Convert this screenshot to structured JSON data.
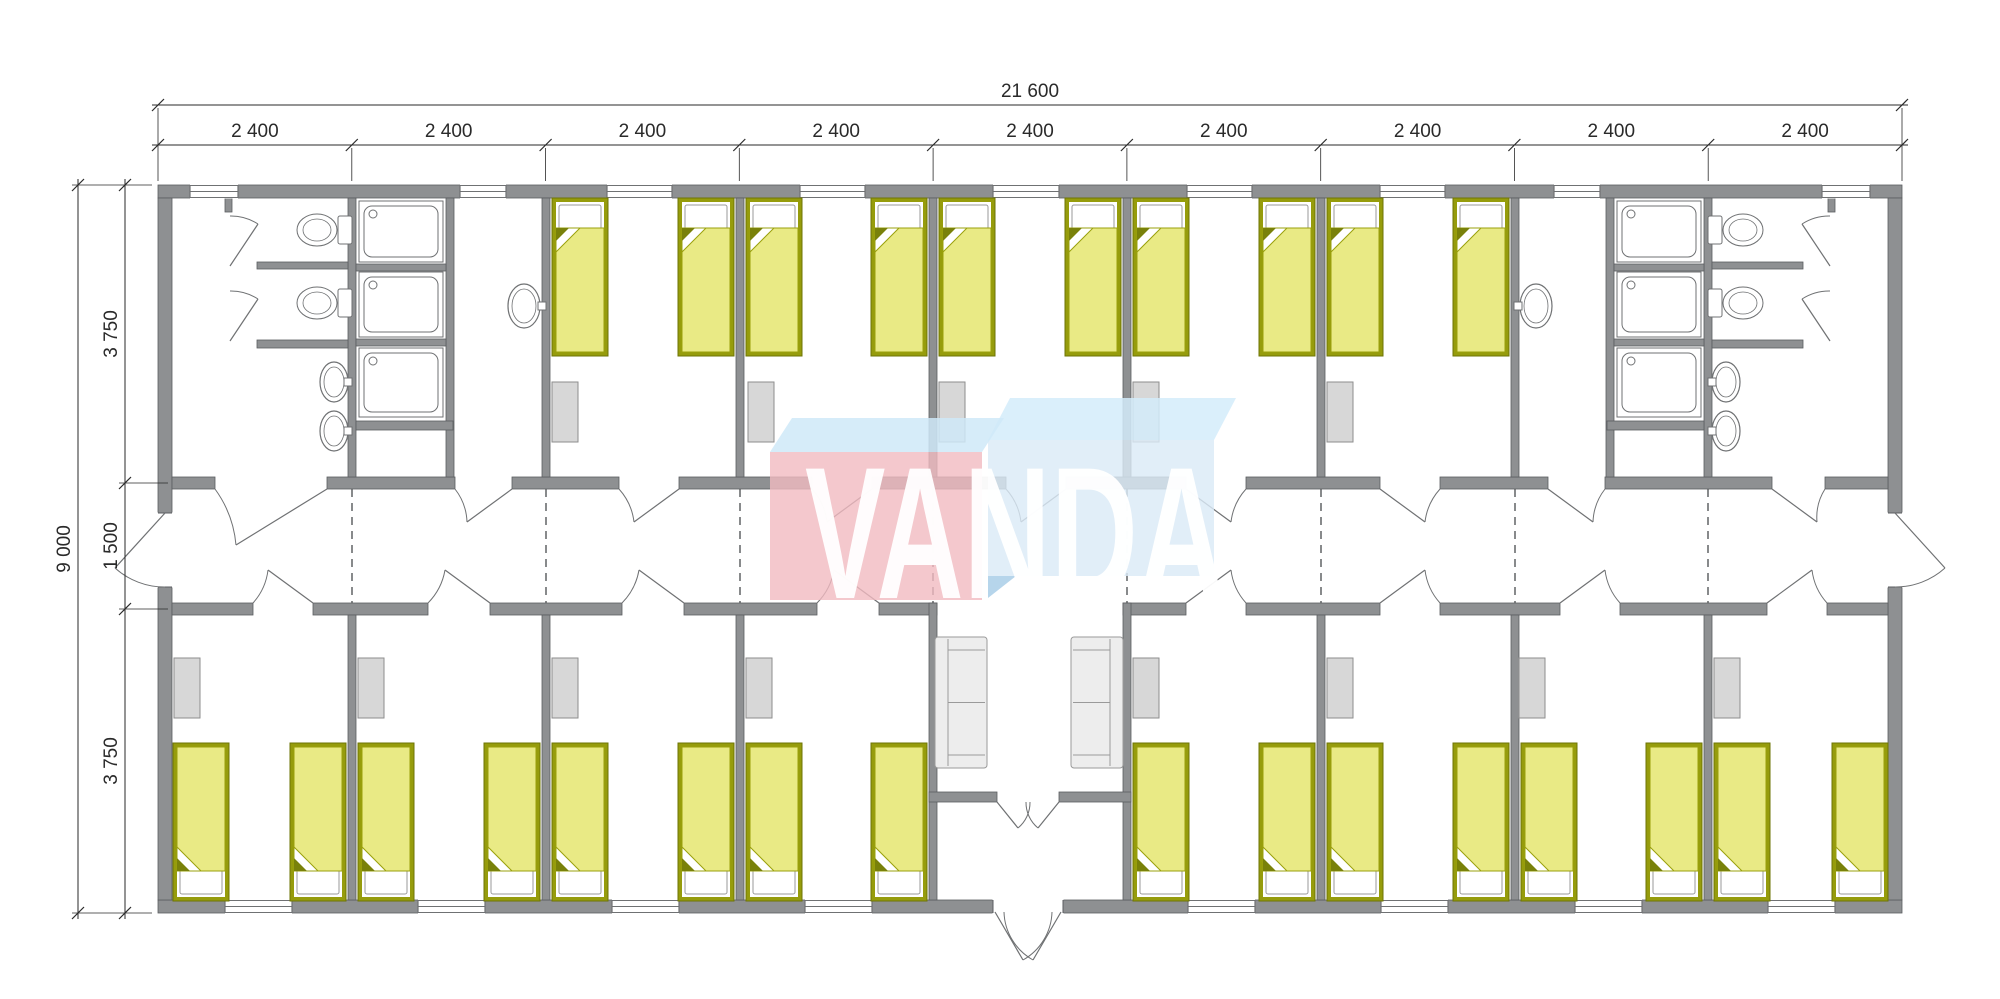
{
  "title": "VANDA modular dormitory floor plan",
  "logo": {
    "text": "VANDA",
    "text_color": "#ffffff",
    "pink_front_color": "#f1bac1",
    "pink_top_color": "#cfe9f8",
    "blue_front_color": "#dbeaf6",
    "blue_top_color": "#d4ecfa",
    "blue_accent_color": "#aed0e9"
  },
  "dimensions": {
    "top_total": {
      "label": "21 600"
    },
    "top_modules": {
      "label": "2 400",
      "count": 9
    },
    "left_total": {
      "label": "9 000"
    },
    "left_rows": [
      "3 750",
      "1 500",
      "3 750"
    ]
  },
  "plan": {
    "canvas": {
      "w": 2000,
      "h": 999
    },
    "colors": {
      "wall_fill": "#8e9092",
      "wall_edge": "#5b5d60",
      "fixture_line": "#6f7173",
      "window_line": "#6f7173",
      "bed_frame": "#969c0c",
      "bed_frame_edge": "#6e7406",
      "bed_blanket": "#e9ea85",
      "bed_blanket_edge": "#9aa00c",
      "bed_fold_dark": "#79810a",
      "pillow_edge": "#999999",
      "locker_fill": "#d7d7d7",
      "locker_edge": "#8e8e8e",
      "sofa_fill": "#ededed",
      "sofa_edge": "#9a9a9a",
      "dashed_line": "#55585a",
      "dim_line": "#2a2a2a"
    },
    "walls": [
      [
        158,
        185,
        1744,
        13
      ],
      [
        158,
        900,
        1744,
        13
      ],
      [
        158,
        198,
        14,
        702
      ],
      [
        1888,
        198,
        14,
        702
      ],
      [
        172,
        477,
        43,
        12
      ],
      [
        327,
        477,
        128,
        12
      ],
      [
        512,
        477,
        107,
        12
      ],
      [
        679,
        477,
        133,
        12
      ],
      [
        872,
        477,
        134,
        12
      ],
      [
        1066,
        477,
        120,
        12
      ],
      [
        1246,
        477,
        134,
        12
      ],
      [
        1440,
        477,
        108,
        12
      ],
      [
        1605,
        477,
        167,
        12
      ],
      [
        1825,
        477,
        63,
        12
      ],
      [
        172,
        603,
        81,
        12
      ],
      [
        313,
        603,
        115,
        12
      ],
      [
        490,
        603,
        132,
        12
      ],
      [
        684,
        603,
        133,
        12
      ],
      [
        879,
        603,
        58,
        12
      ],
      [
        1123,
        603,
        63,
        12
      ],
      [
        1246,
        603,
        134,
        12
      ],
      [
        1440,
        603,
        120,
        12
      ],
      [
        1620,
        603,
        147,
        12
      ],
      [
        1827,
        603,
        61,
        12
      ],
      [
        348,
        198,
        8,
        279
      ],
      [
        446,
        198,
        8,
        279
      ],
      [
        542,
        198,
        8,
        279
      ],
      [
        736,
        198,
        8,
        279
      ],
      [
        929,
        198,
        8,
        279
      ],
      [
        1123,
        198,
        8,
        279
      ],
      [
        1317,
        198,
        8,
        279
      ],
      [
        1511,
        198,
        8,
        279
      ],
      [
        1606,
        198,
        8,
        279
      ],
      [
        1704,
        198,
        8,
        279
      ],
      [
        348,
        615,
        8,
        285
      ],
      [
        542,
        615,
        8,
        285
      ],
      [
        736,
        615,
        8,
        285
      ],
      [
        1317,
        615,
        8,
        285
      ],
      [
        1511,
        615,
        8,
        285
      ],
      [
        1704,
        615,
        8,
        285
      ],
      [
        929,
        603,
        8,
        297
      ],
      [
        1123,
        603,
        8,
        297
      ],
      [
        257,
        262,
        91,
        7
      ],
      [
        257,
        340,
        91,
        8
      ],
      [
        356,
        264,
        90,
        7
      ],
      [
        356,
        339,
        90,
        7
      ],
      [
        356,
        421,
        97,
        9
      ],
      [
        225,
        198,
        7,
        14
      ],
      [
        1712,
        262,
        91,
        7
      ],
      [
        1712,
        340,
        91,
        8
      ],
      [
        1614,
        264,
        90,
        7
      ],
      [
        1614,
        339,
        90,
        7
      ],
      [
        1607,
        421,
        97,
        9
      ],
      [
        1828,
        198,
        7,
        14
      ],
      [
        929,
        792,
        68,
        10
      ],
      [
        1059,
        792,
        72,
        10
      ]
    ],
    "wall_gaps": [
      [
        158,
        513,
        14,
        74
      ],
      [
        1888,
        513,
        14,
        74
      ],
      [
        993,
        900,
        70,
        13
      ]
    ],
    "windows_top": {
      "y": 185,
      "h": 13,
      "items": [
        [
          190,
          48
        ],
        [
          460,
          46
        ],
        [
          607,
          65
        ],
        [
          800,
          65
        ],
        [
          993,
          66
        ],
        [
          1187,
          65
        ],
        [
          1380,
          65
        ],
        [
          1554,
          46
        ],
        [
          1822,
          48
        ]
      ]
    },
    "windows_bottom": {
      "y": 900,
      "h": 13,
      "items": [
        [
          225,
          67
        ],
        [
          418,
          67
        ],
        [
          612,
          67
        ],
        [
          805,
          67
        ],
        [
          1188,
          67
        ],
        [
          1381,
          67
        ],
        [
          1575,
          67
        ],
        [
          1768,
          67
        ]
      ]
    },
    "dashed_joints": {
      "y1": 489,
      "y2": 603,
      "x": [
        352,
        546,
        740,
        933,
        1127,
        1321,
        1515,
        1708
      ]
    },
    "beds": {
      "w": 56,
      "h": 158,
      "top_row_y": 198,
      "top_row_x": [
        552,
        678,
        746,
        871,
        939,
        1065,
        1133,
        1259,
        1327,
        1453
      ],
      "bottom_row_y": 743,
      "bottom_row_x": [
        173,
        290,
        358,
        484,
        552,
        678,
        746,
        871,
        1133,
        1259,
        1327,
        1453,
        1521,
        1646,
        1714,
        1832
      ]
    },
    "lockers": {
      "w": 26,
      "h": 60,
      "top_y": 382,
      "top_x": [
        552,
        748,
        939,
        1133,
        1327
      ],
      "bottom_y": 658,
      "bottom_x": [
        174,
        358,
        552,
        746,
        1133,
        1327,
        1519,
        1714
      ]
    },
    "sofas": {
      "w": 52,
      "h": 131,
      "y": 637,
      "items": [
        {
          "x": 935,
          "back": "left"
        },
        {
          "x": 1071,
          "back": "right"
        }
      ]
    },
    "showers": {
      "w": 84,
      "cols": [
        359,
        1617
      ],
      "rows": [
        [
          201,
          61
        ],
        [
          272,
          65
        ],
        [
          348,
          69
        ]
      ]
    },
    "toilets": [
      {
        "bowl_cx": 317,
        "cy": 230,
        "tank_x": 338,
        "facing": "left"
      },
      {
        "bowl_cx": 317,
        "cy": 303,
        "tank_x": 338,
        "facing": "left"
      },
      {
        "bowl_cx": 1743,
        "cy": 230,
        "tank_x": 1708,
        "facing": "right"
      },
      {
        "bowl_cx": 1743,
        "cy": 303,
        "tank_x": 1708,
        "facing": "right"
      }
    ],
    "sinks": [
      {
        "cx": 334,
        "cy": 382,
        "rx": 14,
        "ry": 20,
        "tap": [
          344,
          378
        ]
      },
      {
        "cx": 334,
        "cy": 431,
        "rx": 14,
        "ry": 20,
        "tap": [
          344,
          427
        ]
      },
      {
        "cx": 1726,
        "cy": 382,
        "rx": 14,
        "ry": 20,
        "tap": [
          1708,
          378
        ]
      },
      {
        "cx": 1726,
        "cy": 431,
        "rx": 14,
        "ry": 20,
        "tap": [
          1708,
          427
        ]
      },
      {
        "cx": 524,
        "cy": 306,
        "rx": 16,
        "ry": 22,
        "tap": [
          538,
          302
        ]
      },
      {
        "cx": 1536,
        "cy": 306,
        "rx": 16,
        "ry": 22,
        "tap": [
          1514,
          302
        ]
      }
    ],
    "doors": [
      {
        "h": [
          327,
          489
        ],
        "t": [
          236,
          545
        ],
        "a": [
          215,
          489
        ],
        "f": 1
      },
      {
        "h": [
          512,
          489
        ],
        "t": [
          467,
          522
        ],
        "a": [
          455,
          489
        ],
        "f": 1
      },
      {
        "h": [
          679,
          489
        ],
        "t": [
          634,
          522
        ],
        "a": [
          619,
          489
        ],
        "f": 1
      },
      {
        "h": [
          872,
          489
        ],
        "t": [
          827,
          522
        ],
        "a": [
          812,
          489
        ],
        "f": 1
      },
      {
        "h": [
          1066,
          489
        ],
        "t": [
          1021,
          522
        ],
        "a": [
          1006,
          489
        ],
        "f": 1
      },
      {
        "h": [
          1186,
          489
        ],
        "t": [
          1231,
          522
        ],
        "a": [
          1246,
          489
        ],
        "f": 0
      },
      {
        "h": [
          1380,
          489
        ],
        "t": [
          1425,
          522
        ],
        "a": [
          1440,
          489
        ],
        "f": 0
      },
      {
        "h": [
          1548,
          489
        ],
        "t": [
          1593,
          522
        ],
        "a": [
          1605,
          489
        ],
        "f": 0
      },
      {
        "h": [
          1772,
          489
        ],
        "t": [
          1817,
          522
        ],
        "a": [
          1825,
          489
        ],
        "f": 0
      },
      {
        "h": [
          313,
          603
        ],
        "t": [
          268,
          570
        ],
        "a": [
          253,
          603
        ],
        "f": 0
      },
      {
        "h": [
          490,
          603
        ],
        "t": [
          445,
          570
        ],
        "a": [
          428,
          603
        ],
        "f": 0
      },
      {
        "h": [
          684,
          603
        ],
        "t": [
          639,
          570
        ],
        "a": [
          622,
          603
        ],
        "f": 0
      },
      {
        "h": [
          879,
          603
        ],
        "t": [
          834,
          570
        ],
        "a": [
          817,
          603
        ],
        "f": 0
      },
      {
        "h": [
          1186,
          603
        ],
        "t": [
          1231,
          570
        ],
        "a": [
          1246,
          603
        ],
        "f": 1
      },
      {
        "h": [
          1380,
          603
        ],
        "t": [
          1425,
          570
        ],
        "a": [
          1440,
          603
        ],
        "f": 1
      },
      {
        "h": [
          1560,
          603
        ],
        "t": [
          1605,
          570
        ],
        "a": [
          1620,
          603
        ],
        "f": 1
      },
      {
        "h": [
          1767,
          603
        ],
        "t": [
          1812,
          570
        ],
        "a": [
          1827,
          603
        ],
        "f": 1
      },
      {
        "h": [
          230,
          266
        ],
        "t": [
          258,
          224
        ],
        "a": [
          230,
          216
        ],
        "f": 1
      },
      {
        "h": [
          230,
          341
        ],
        "t": [
          258,
          299
        ],
        "a": [
          230,
          291
        ],
        "f": 1
      },
      {
        "h": [
          1830,
          266
        ],
        "t": [
          1802,
          224
        ],
        "a": [
          1830,
          216
        ],
        "f": 0
      },
      {
        "h": [
          1830,
          341
        ],
        "t": [
          1802,
          299
        ],
        "a": [
          1830,
          291
        ],
        "f": 0
      },
      {
        "h": [
          997,
          802
        ],
        "t": [
          1018,
          828
        ],
        "a": [
          1030,
          802
        ],
        "f": 1
      },
      {
        "h": [
          1059,
          802
        ],
        "t": [
          1038,
          828
        ],
        "a": [
          1026,
          802
        ],
        "f": 0
      },
      {
        "h": [
          995,
          912
        ],
        "t": [
          1023,
          960
        ],
        "a": [
          1052,
          912
        ],
        "f": 1
      },
      {
        "h": [
          1061,
          912
        ],
        "t": [
          1033,
          960
        ],
        "a": [
          1004,
          912
        ],
        "f": 0
      },
      {
        "h": [
          165,
          513
        ],
        "t": [
          115,
          568
        ],
        "a": [
          165,
          587
        ],
        "f": 1
      },
      {
        "h": [
          1895,
          513
        ],
        "t": [
          1945,
          568
        ],
        "a": [
          1895,
          587
        ],
        "f": 0
      }
    ],
    "logo_geometry": {
      "blue_top": "988,440 1010,398 1236,398 1214,440",
      "blue_front": [
        988,
        440,
        226,
        136
      ],
      "blue_accent": "988,576 988,598 1016,576",
      "pink_top": "770,452 792,418 1004,418 982,452",
      "pink_front": [
        770,
        452,
        212,
        148
      ],
      "text_x": 805,
      "text_y": 598,
      "text_size": 188,
      "text_length": 420
    },
    "dims": {
      "top_total_line": {
        "y": 105,
        "x1": 152,
        "x2": 1908,
        "ticks": [
          158,
          1902
        ],
        "label_x": 1030,
        "label_y": 97
      },
      "module_line": {
        "y": 145,
        "x1": 152,
        "x2": 1908,
        "ticks": [
          158,
          351.8,
          545.6,
          739.3,
          933.1,
          1126.9,
          1320.7,
          1514.4,
          1708.2,
          1902
        ],
        "label_y": 137,
        "label_x": [
          254.9,
          448.7,
          642.4,
          836.2,
          1030,
          1223.8,
          1417.6,
          1611.3,
          1805.1
        ]
      },
      "left_total_line": {
        "x": 78,
        "y1": 179,
        "y2": 919,
        "ticks": [
          185,
          913
        ],
        "label_x": 70,
        "label_y": 549
      },
      "left_rows_line": {
        "x": 125,
        "y1": 179,
        "y2": 919,
        "ticks": [
          185,
          483,
          609,
          913
        ],
        "label_x": 117,
        "label_y": [
          334,
          546,
          761
        ]
      },
      "ext_lines": [
        [
          158,
          108,
          158,
          181
        ],
        [
          1902,
          108,
          1902,
          181
        ],
        [
          351.8,
          148,
          351.8,
          181
        ],
        [
          545.6,
          148,
          545.6,
          181
        ],
        [
          739.3,
          148,
          739.3,
          181
        ],
        [
          933.1,
          148,
          933.1,
          181
        ],
        [
          1126.9,
          148,
          1126.9,
          181
        ],
        [
          1320.7,
          148,
          1320.7,
          181
        ],
        [
          1514.4,
          148,
          1514.4,
          181
        ],
        [
          1708.2,
          148,
          1708.2,
          181
        ],
        [
          72,
          185,
          152,
          185
        ],
        [
          72,
          913,
          152,
          913
        ],
        [
          119,
          483,
          168,
          483
        ],
        [
          119,
          609,
          168,
          609
        ]
      ]
    }
  }
}
